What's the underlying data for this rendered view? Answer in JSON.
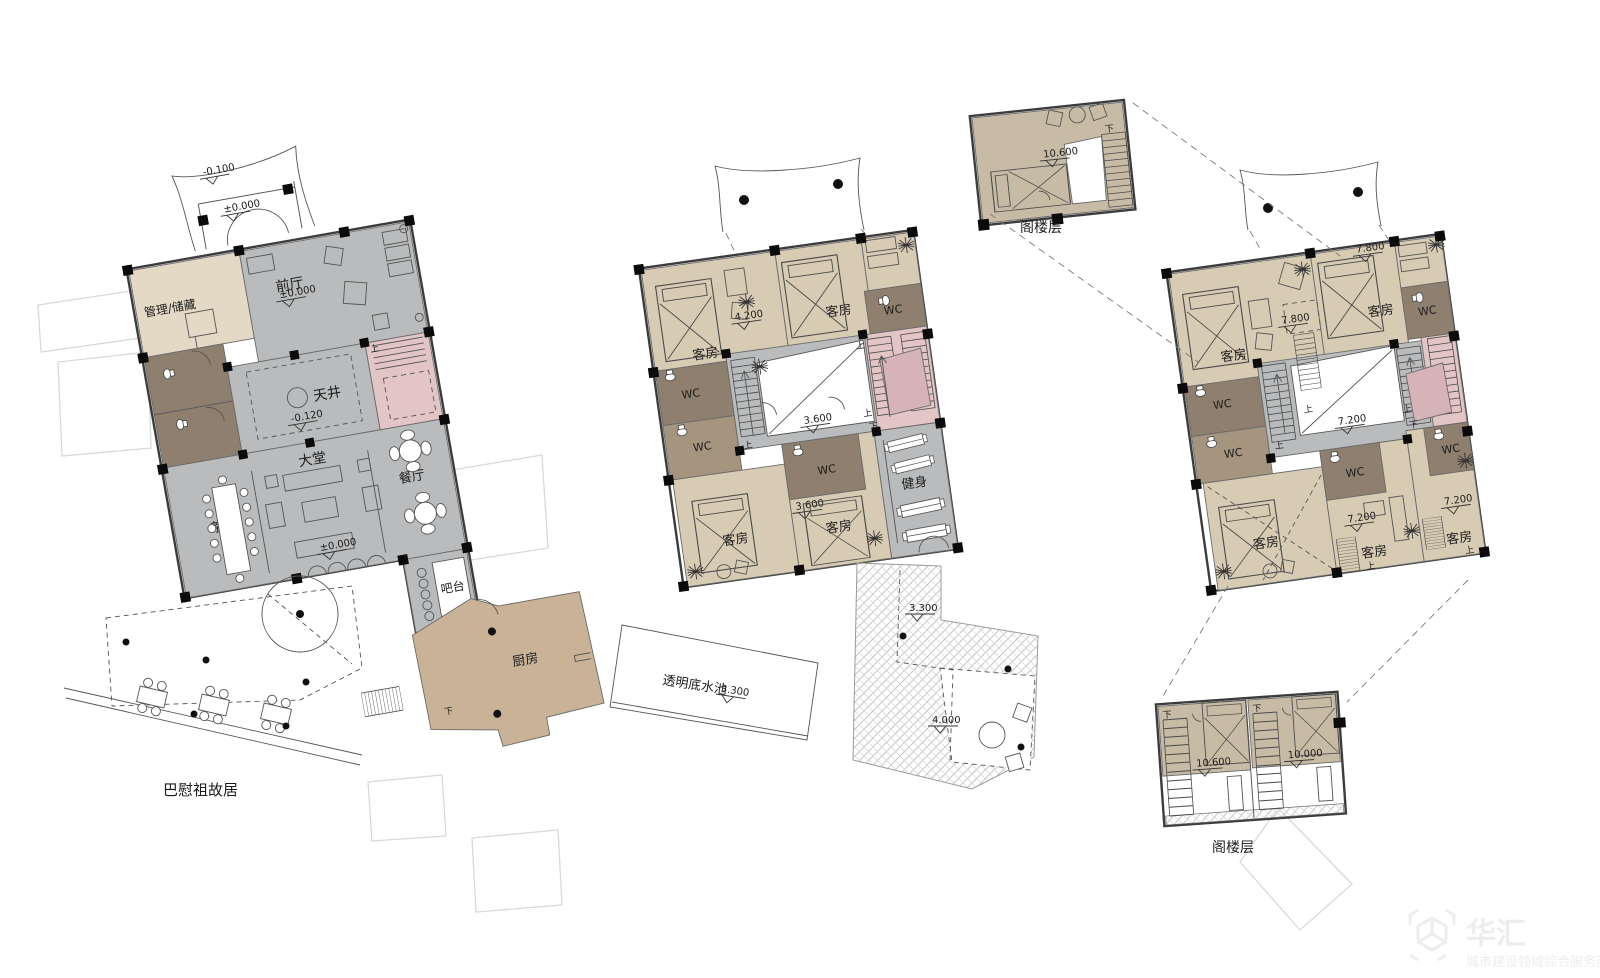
{
  "drawing": {
    "kind": "architectural-floor-plans",
    "plan_count": 3,
    "attic_inset_count": 2
  },
  "strings": {
    "mgmt_storage": "管理/储藏",
    "front_hall": "前厅",
    "courtyard": "天井",
    "lobby": "大堂",
    "tea_art": "茶艺",
    "dining": "餐厅",
    "bar": "吧台",
    "kitchen": "厨房",
    "site_name": "巴慰祖故居",
    "guest_room": "客房",
    "wc": "WC",
    "fitness": "健身",
    "pool": "透明底水池",
    "attic_floor": "阁楼层",
    "up": "上",
    "down": "下"
  },
  "levels": {
    "neg_0_100": "-0.100",
    "zero": "±0.000",
    "neg_0_120": "-0.120",
    "l3_300": "3.300",
    "l3_600": "3.600",
    "l4_000": "4.000",
    "l4_200": "4.200",
    "l7_200": "7.200",
    "l7_800": "7.800",
    "l10_000": "10.000",
    "l10_600": "10.600"
  },
  "colors": {
    "public_gray": "#b9bbbd",
    "room_beige": "#d8cbb3",
    "room_beige_light": "#e4d9c5",
    "wc_brown": "#8f7f6e",
    "wc_brown_light": "#a5957f",
    "stair_pink": "#e2c5c4",
    "stair_pink_dark": "#d6b3b6",
    "kitchen_tan": "#c9b295",
    "attic_tan": "#c8bba5",
    "wall_line": "#3c3c3c"
  },
  "watermark": {
    "brand": "华汇",
    "tagline": "城市建设领域综合服务商"
  }
}
